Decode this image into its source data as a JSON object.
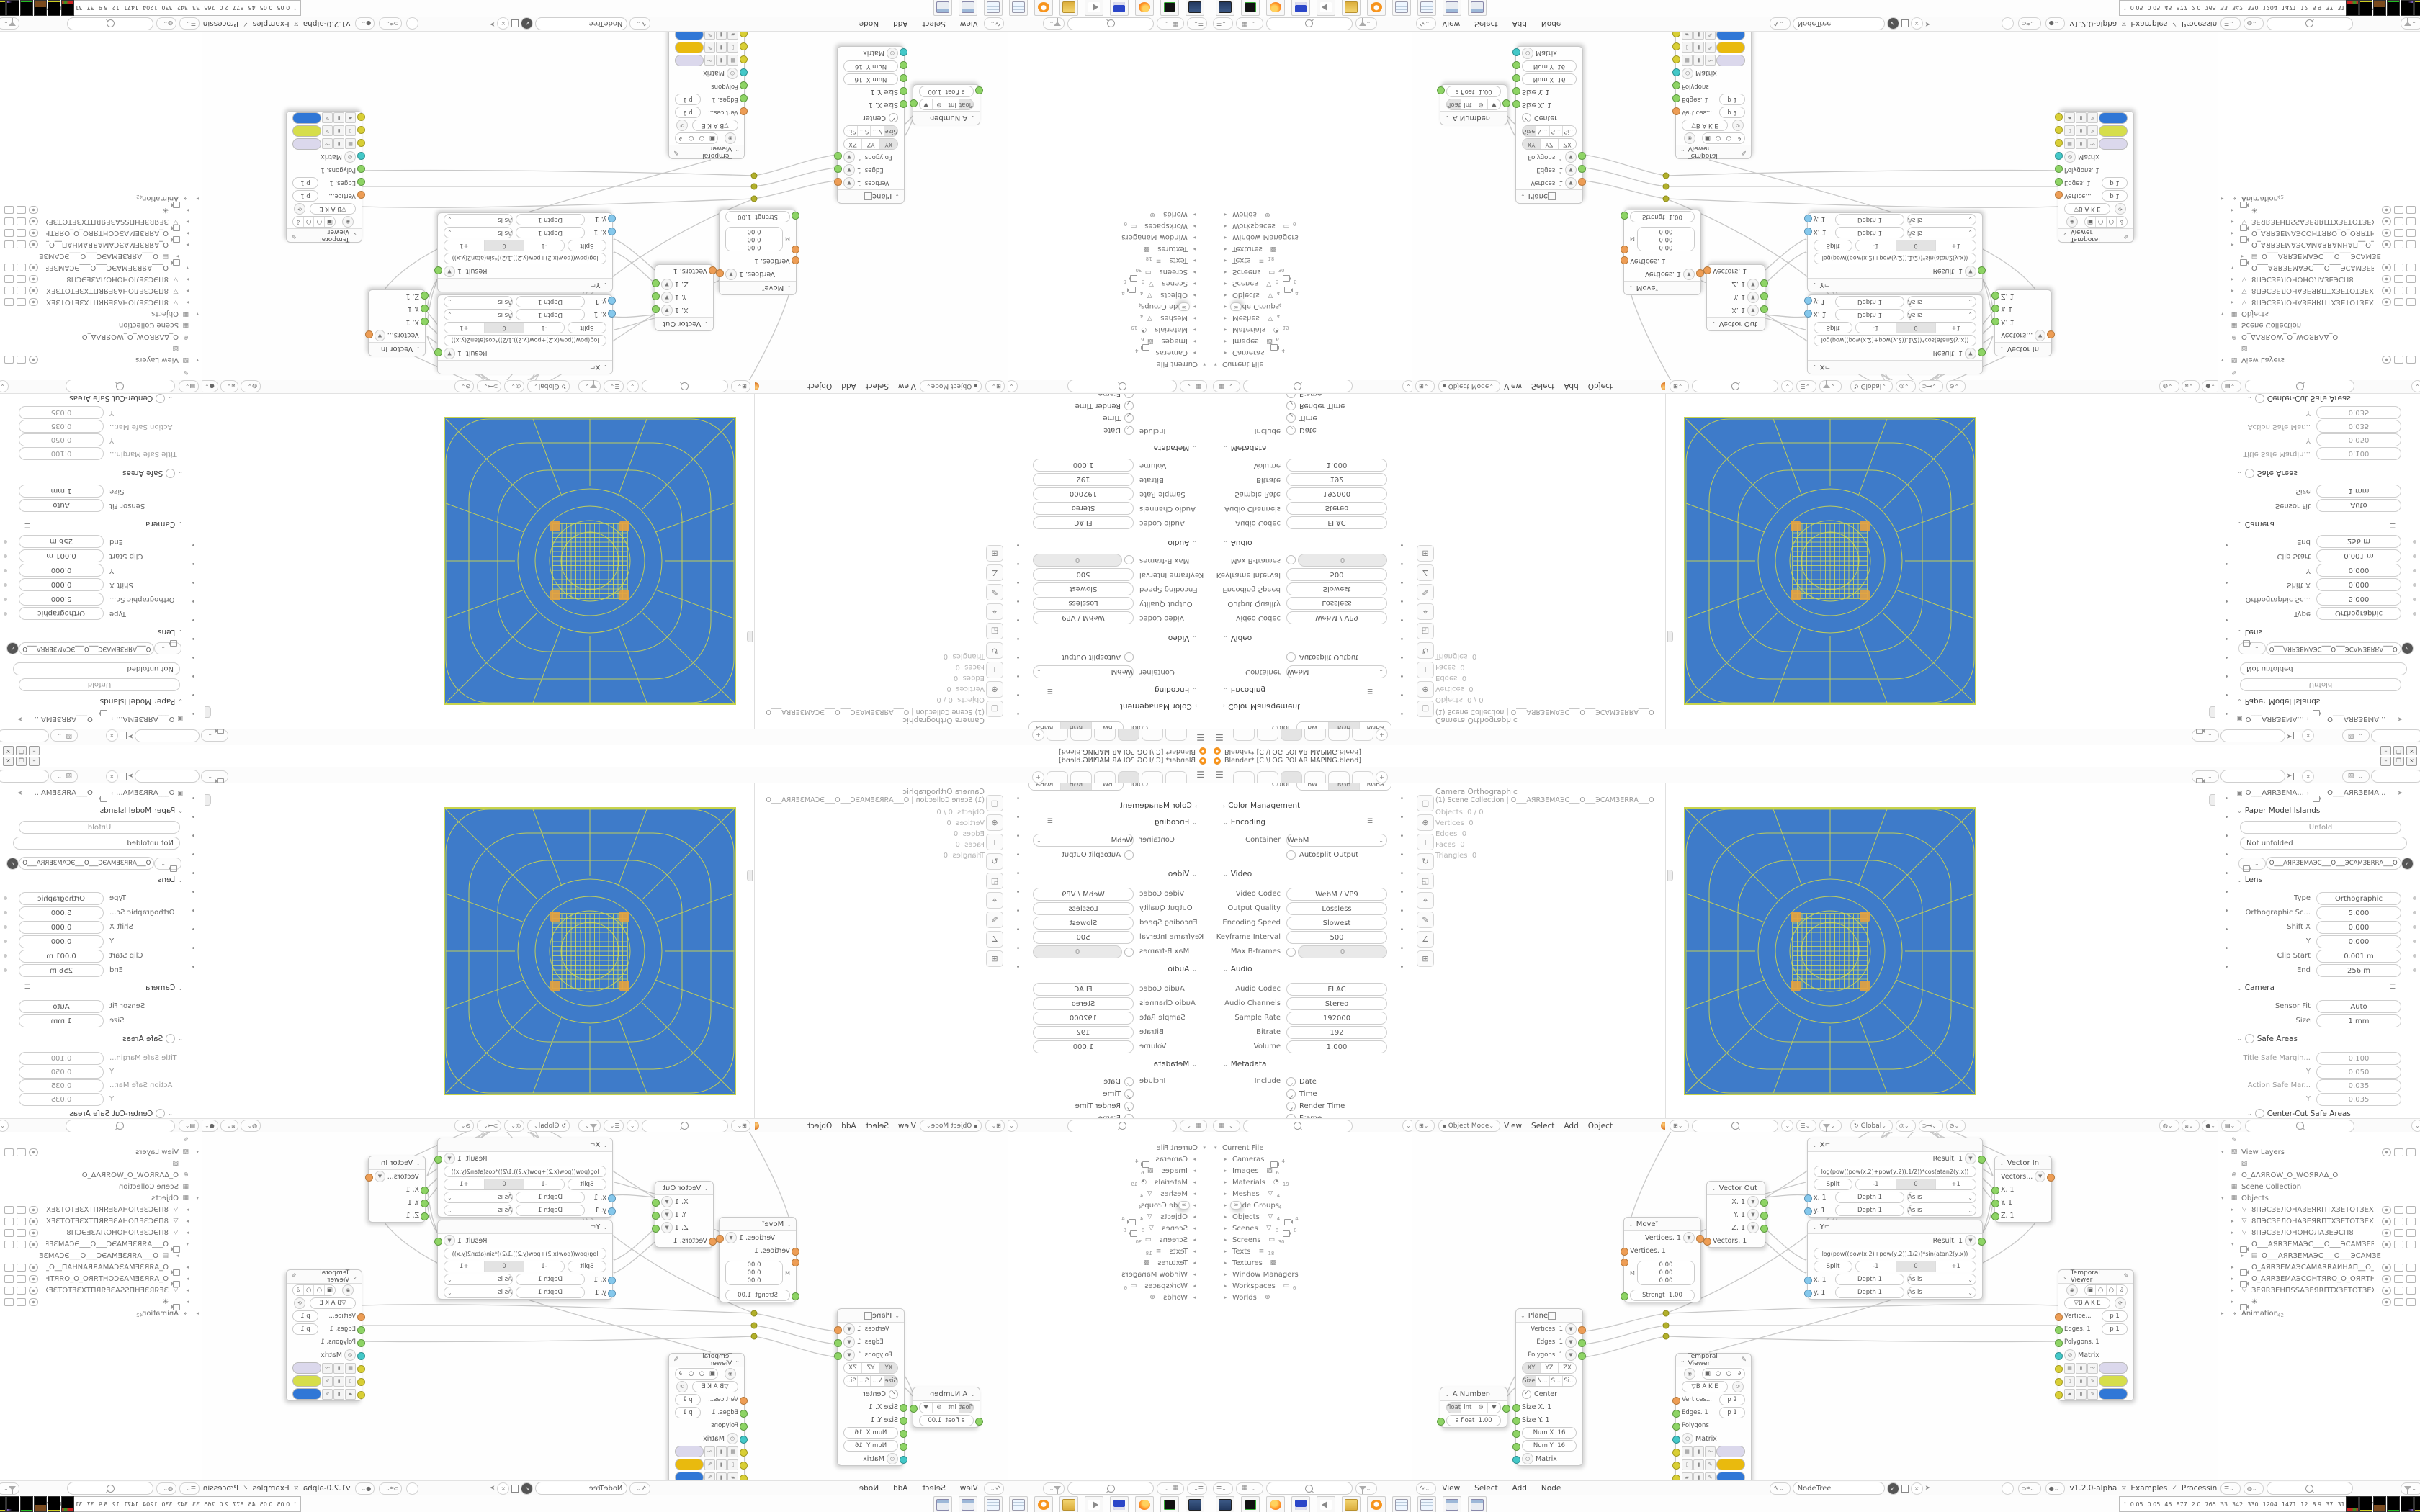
{
  "window": {
    "title": "Blender* [C:\\LOG POLAR MAPING.blend]",
    "buttons": {
      "minimize": "–",
      "restore": "❐",
      "close": "×"
    }
  },
  "topbar": {
    "tabs_count_label": "+",
    "scene_selector": {
      "value": "",
      "icons": [
        "scene-icon",
        "pin-icon",
        "copy-icon",
        "close-icon"
      ]
    },
    "viewlayer_selector": {
      "value": "",
      "icons": [
        "viewlayer-icon",
        "copy-icon",
        "close-icon"
      ]
    }
  },
  "colors": {
    "camera_blue": "#3E7BC9",
    "web_yellow": "#C8D44C",
    "swatch_lavender": "#DBD8EC",
    "swatch_yellowgreen": "#D6DE4B",
    "swatch_gold": "#E9BA0E",
    "swatch_blue": "#3077D6"
  },
  "props_output": {
    "color_label": "Color",
    "color_modes": [
      "BW",
      "RGB",
      "RGBA"
    ],
    "color_management": "Color Management",
    "encoding": "Encoding",
    "container": {
      "label": "Container",
      "value": "WebM"
    },
    "autosplit": "Autosplit Output",
    "video": "Video",
    "video_rows": [
      {
        "label": "Video Codec",
        "value": "WebM / VP9"
      },
      {
        "label": "Output Quality",
        "value": "Lossless"
      },
      {
        "label": "Encoding Speed",
        "value": "Slowest"
      },
      {
        "label": "Keyframe Interval",
        "value": "500"
      }
    ],
    "maxb": {
      "label": "Max B-frames",
      "value": "0"
    },
    "audio": "Audio",
    "audio_rows": [
      {
        "label": "Audio Codec",
        "value": "FLAC"
      },
      {
        "label": "Audio Channels",
        "value": "Stereo"
      },
      {
        "label": "Sample Rate",
        "value": "192000"
      },
      {
        "label": "Bitrate",
        "value": "192"
      },
      {
        "label": "Volume",
        "value": "1.000"
      }
    ],
    "metadata": "Metadata",
    "include_label": "Include",
    "metadata_checks": [
      "Date",
      "Time",
      "Render Time",
      "Frame",
      "Frame Range"
    ],
    "tab_icons": [
      "tool-icon",
      "render-icon",
      "output-icon",
      "viewlayer-icon",
      "scene-icon",
      "world-icon",
      "object-icon",
      "modifier-icon",
      "data-icon",
      "physics-icon"
    ]
  },
  "outliner_file": {
    "rows": [
      {
        "a": "▾",
        "c": "",
        "label": "Current File",
        "c1": "",
        "n1": "",
        "c2": "",
        "n2": "",
        "k": ""
      },
      {
        "a": "▸",
        "c": "",
        "label": "Cameras",
        "c1": "vcam",
        "n1": "4",
        "c2": "",
        "n2": "",
        "k": "ind1"
      },
      {
        "a": "▸",
        "c": "",
        "label": "Images",
        "c1": "img",
        "n1": "6",
        "c2": "",
        "n2": "",
        "k": "ind1"
      },
      {
        "a": "▸",
        "c": "",
        "label": "Materials",
        "c1": "mat",
        "n1": "19",
        "c2": "",
        "n2": "",
        "k": "ind1"
      },
      {
        "a": "▸",
        "c": "",
        "label": "Meshes",
        "c1": "mesh",
        "n1": "4",
        "c2": "",
        "n2": "",
        "k": "ind1"
      },
      {
        "a": "▸",
        "c": "",
        "label": "Node Groups",
        "c1": "node",
        "n1": "4",
        "c2": "",
        "n2": "",
        "k": "ind1"
      },
      {
        "a": "▸",
        "c": "",
        "label": "Objects",
        "c1": "mesh",
        "n1": "4",
        "c2": "vcam",
        "n2": "4",
        "k": "ind1"
      },
      {
        "a": "▸",
        "c": "",
        "label": "Scenes",
        "c1": "mesh",
        "n1": "8",
        "c2": "vcam",
        "n2": "8",
        "k": "ind1"
      },
      {
        "a": "▸",
        "c": "",
        "label": "Screens",
        "c1": "scr",
        "n1": "30",
        "c2": "",
        "n2": "",
        "k": "ind1"
      },
      {
        "a": "▸",
        "c": "",
        "label": "Texts",
        "c1": "txt",
        "n1": "18",
        "c2": "",
        "n2": "",
        "k": "ind1"
      },
      {
        "a": "▸",
        "c": "",
        "label": "Textures",
        "c1": "chk",
        "n1": "",
        "c2": "",
        "n2": "",
        "k": "ind1"
      },
      {
        "a": "▸",
        "c": "",
        "label": "Window Managers",
        "c1": "",
        "n1": "",
        "c2": "",
        "n2": "",
        "k": "ind1"
      },
      {
        "a": "▸",
        "c": "",
        "label": "Workspaces",
        "c1": "scr",
        "n1": "6",
        "c2": "",
        "n2": "",
        "k": "ind1"
      },
      {
        "a": "▸",
        "c": "",
        "label": "Worlds",
        "c1": "world",
        "n1": "",
        "c2": "",
        "n2": "",
        "k": "ind1"
      }
    ]
  },
  "viewport": {
    "overlay_line1": "Camera Orthographic",
    "overlay_line2": "(1) Scene Collection | O___АЯRЗЕМАЭС___О___ЭСАМЗЕRRА___О",
    "stats": [
      {
        "l": "Objects",
        "v": "0 / 0"
      },
      {
        "l": "Vertices",
        "v": "0"
      },
      {
        "l": "Edges",
        "v": "0"
      },
      {
        "l": "Faces",
        "v": "0"
      },
      {
        "l": "Triangles",
        "v": "0"
      }
    ],
    "tools": [
      {
        "name": "select-box-tool-icon",
        "g": "▢"
      },
      {
        "name": "cursor-tool-icon",
        "g": "⊕"
      },
      {
        "name": "move-tool-icon",
        "g": "+"
      },
      {
        "name": "rotate-tool-icon",
        "g": "↻"
      },
      {
        "name": "scale-tool-icon",
        "g": "◱"
      },
      {
        "name": "transform-tool-icon",
        "g": "⌖"
      },
      {
        "name": "annotate-tool-icon",
        "g": "✎"
      },
      {
        "name": "measure-tool-icon",
        "g": "∠"
      },
      {
        "name": "add-cube-tool-icon",
        "g": "⊞"
      }
    ],
    "headerA": {
      "mode": "Object Mode",
      "menus": [
        "View",
        "Select",
        "Add",
        "Object"
      ]
    },
    "headerB": {
      "orientation": "Global"
    }
  },
  "props_camera": {
    "breadcrumb_a": "O___АЯRЗЕМА...",
    "breadcrumb_b": "O___АЯRЗЕМА...",
    "paper_model": "Paper Model Islands",
    "unfold_btn": "Unfold",
    "not_unfolded": "Not unfolded",
    "datablock": "O___АЯRЗЕМАЭС___О___ЭСАМЗЕRRА___О",
    "lens": "Lens",
    "lens_rows": [
      {
        "label": "Type",
        "value": "Orthographic"
      },
      {
        "label": "Orthographic Sc...",
        "value": "5.000"
      },
      {
        "label": "Shift X",
        "value": "0.000"
      },
      {
        "label": "Y",
        "value": "0.000"
      },
      {
        "label": "Clip Start",
        "value": "0.001 m"
      },
      {
        "label": "End",
        "value": "256 m"
      }
    ],
    "camera": "Camera",
    "camera_rows": [
      {
        "label": "Sensor Fit",
        "value": "Auto"
      },
      {
        "label": "Size",
        "value": "1 mm"
      }
    ],
    "safe_areas": "Safe Areas",
    "safe_rows": [
      {
        "label": "Title Safe Margin...",
        "value": "0.100"
      },
      {
        "label": "Y",
        "value": "0.050"
      },
      {
        "label": "Action Safe Mar...",
        "value": "0.035"
      },
      {
        "label": "Y",
        "value": "0.035"
      }
    ],
    "center_cut": "Center-Cut Safe Areas",
    "tab_icons": [
      "tool-icon",
      "render-icon",
      "output-icon",
      "viewlayer-icon",
      "scene-icon",
      "world-icon",
      "object-icon",
      "constraint-icon",
      "modifier-icon",
      "camera-data-icon"
    ]
  },
  "outliner_scene": {
    "rows": [
      {
        "a": "",
        "c": "brush",
        "label": "",
        "x": "",
        "sup": "",
        "t": "",
        "k": ""
      },
      {
        "a": "▾",
        "c": "img",
        "label": "View Layers",
        "x": "",
        "sup": "",
        "t": "cam",
        "k": ""
      },
      {
        "a": "",
        "c": "imgbox",
        "label": "",
        "x": "",
        "sup": "",
        "t": "",
        "k": "ind1"
      },
      {
        "a": "",
        "c": "world",
        "label": "O_ΔΛЯROW_O_WOЯRΛΔ_О",
        "x": "",
        "sup": "",
        "t": "",
        "k": ""
      },
      {
        "a": "",
        "c": "coll",
        "label": "Scene Collection",
        "x": "",
        "sup": "",
        "t": "",
        "k": ""
      },
      {
        "a": "▾",
        "c": "coll",
        "label": "Objects",
        "x": "",
        "sup": "",
        "t": "",
        "k": ""
      },
      {
        "a": "▸",
        "c": "mesh",
        "label": "8ПЭСЗЕЛОНАЗЕЯRПТХЗЕТОТЗЕХТПЯI",
        "x": "",
        "sup": "",
        "t": "evc",
        "k": "ind1"
      },
      {
        "a": "▸",
        "c": "mesh",
        "label": "8ПЭСЗЕЛОНАЗЕЯRПТХЗЕТОТЗЕХТПЯI",
        "x": "",
        "sup": "",
        "t": "evc",
        "k": "ind1"
      },
      {
        "a": "▸",
        "c": "mesh",
        "label": "8ПЭСЗЕЛОНÖНОЛАЗЕЭСП8",
        "x": "▽",
        "sup": "",
        "t": "evc",
        "k": "ind1"
      },
      {
        "a": "▾",
        "c": "vcam",
        "label": "O___АЯRЗЕМАЭС___О___ЭСАМЗЕRRА",
        "x": "",
        "sup": "",
        "t": "evc",
        "k": "ind1"
      },
      {
        "a": "▸",
        "c": "film",
        "label": "O___АЯRЗЕМАЭС___О___ЭСАМЗЕ",
        "x": "",
        "sup": "",
        "t": "",
        "k": "ind2"
      },
      {
        "a": "▸",
        "c": "vcam",
        "label": "O_АЯRЗЕМАЭСАМАRRАИНАП__О__ПА",
        "x": "",
        "sup": "",
        "t": "evc",
        "k": "ind1"
      },
      {
        "a": "▸",
        "c": "vcam",
        "label": "O_АЯRЗЕМАЭСОНТЯRО_О_ОЯRТНОЭСУ",
        "x": "",
        "sup": "",
        "t": "evc",
        "k": "ind1"
      },
      {
        "a": "▸",
        "c": "mesh",
        "label": "ЗЕЯRЗЕНПSSАЗЕЯRПТХЗЕТОТЗЕХТПS",
        "x": "",
        "sup": "",
        "t": "evc",
        "k": "ind1"
      },
      {
        "a": "▸",
        "c": "vcam",
        "label": "✳",
        "x": "",
        "sup": "",
        "t": "evc",
        "k": "ind1"
      },
      {
        "a": "▸",
        "c": "anim",
        "label": "Animation",
        "x": "",
        "sup": "42",
        "t": "",
        "k": ""
      }
    ]
  },
  "node_editor": {
    "header_left_menus": [
      "View",
      "Select",
      "Add",
      "Node"
    ],
    "tree_name": "NodeTree",
    "version": "v1.2.0-alpha",
    "examples": "Examples",
    "processing": "Processing",
    "nodes": {
      "move": {
        "title": "Move",
        "out": "Vertices. 1",
        "in1": "Vertices. 1",
        "m": "M",
        "vec": [
          "0.00",
          "0.00",
          "0.00"
        ],
        "strength_label": "Strengt",
        "strength": "1.00"
      },
      "vector_out": {
        "title": "Vector Out",
        "outs": [
          "X. 1",
          "Y. 1",
          "Z. 1"
        ],
        "in1": "Vectors. 1"
      },
      "x_node": {
        "title": "X",
        "result": "Result. 1",
        "formula": "log(pow((pow(x,2)+pow(y,2)),1/2))*cos(atan2(y,x))",
        "split": "Split",
        "minus": "-1",
        "zero": "0",
        "plus": "+1",
        "in_x": "x. 1",
        "in_y": "y. 1",
        "depth_label": "Depth",
        "depth_val": "1",
        "asis": "As is"
      },
      "y_node": {
        "title": "Y",
        "result": "Result. 1",
        "formula": "log(pow((pow(x,2)+pow(y,2)),1/2))*sin(atan2(y,x))",
        "split": "Split",
        "minus": "-1",
        "zero": "0",
        "plus": "+1",
        "in_x": "x. 1",
        "in_y": "y. 1",
        "depth_label": "Depth",
        "depth_val": "1",
        "asis": "As is"
      },
      "vector_in": {
        "title": "Vector In",
        "out": "Vectors...",
        "ins": [
          "X. 1",
          "Y. 1",
          "Z. 1"
        ]
      },
      "tv1": {
        "title": "Temporal Viewer",
        "bake": "B A K E",
        "vert_label": "Vertice...",
        "vert_p": "p  1",
        "edge_label": "Edges. 1",
        "edge_p": "p  1",
        "poly_label": "Polygons. 1",
        "matrix_label": "Matrix"
      },
      "tv2": {
        "title": "Temporal Viewer",
        "bake": "B A K E",
        "vert_label": "Vertices...",
        "vert_p": "p  2",
        "edge_label": "Edges. 1",
        "edge_p": "p  1",
        "poly_label": "Polygons",
        "matrix_label": "Matrix"
      },
      "a_number": {
        "title": "A Number",
        "float_b": "float",
        "int_b": "int",
        "in_label": "a float",
        "in_val": "1.00"
      },
      "plane": {
        "title": "Plane",
        "outs": [
          "Vertices. 1",
          "Edges. 1",
          "Polygons. 1"
        ],
        "axes": [
          "XY",
          "YZ",
          "ZX"
        ],
        "size_modes": [
          "Size",
          "N...",
          "S...",
          "Si..."
        ],
        "center": "Center",
        "ins": [
          {
            "label": "Size X. 1"
          },
          {
            "label": "Size Y. 1"
          }
        ],
        "numx": {
          "label": "Num X",
          "value": "16"
        },
        "numy": {
          "label": "Num Y",
          "value": "16"
        },
        "matrix_label": "Matrix"
      }
    }
  },
  "taskbar": {
    "apps": [
      {
        "name": "system-monitor-icon",
        "k": "tb-mon"
      },
      {
        "name": "terminal-icon",
        "k": "tb-term"
      },
      {
        "name": "firefox-icon",
        "k": "tb-ffx"
      },
      {
        "name": "floppy-64-icon",
        "k": "tb-flp"
      },
      {
        "name": "volume-icon",
        "k": "tb-vol"
      },
      {
        "name": "folder-icon",
        "k": "tb-fold"
      },
      {
        "name": "blender-icon",
        "k": "tb-blend"
      },
      {
        "name": "notepad-icon",
        "k": "tb-note"
      },
      {
        "name": "notepad-icon",
        "k": "tb-note"
      },
      {
        "name": "calculator-icon",
        "k": "tb-calc"
      },
      {
        "name": "calculator-icon",
        "k": "tb-calc"
      }
    ],
    "monitor_numbers": [
      "0.05",
      "0.05",
      "45",
      "877",
      "2.0",
      "765",
      "33",
      "342",
      "330",
      "1204",
      "1471",
      "12",
      "8.9",
      "37",
      "31",
      "4683",
      "6354"
    ],
    "graphs": [
      "g-red",
      "g-yel",
      "g-brown",
      "g-green",
      "g-pur",
      "g-yel2"
    ]
  }
}
